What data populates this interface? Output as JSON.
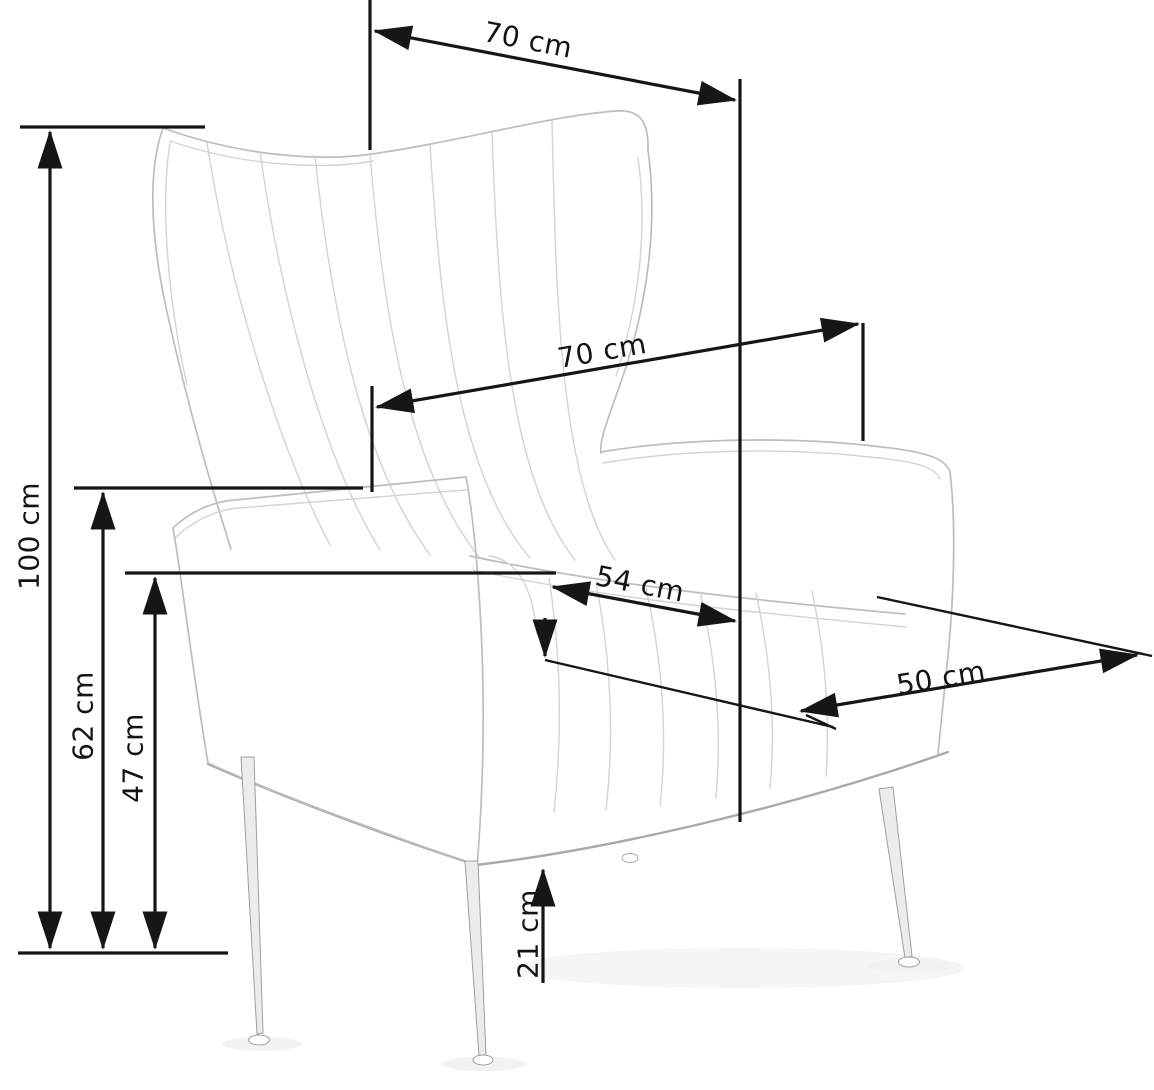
{
  "diagram": {
    "type": "furniture-dimension-drawing",
    "subject": "wingback armchair line sketch with metal legs",
    "unit": "cm",
    "background_color": "#ffffff",
    "dimension_line_color": "#161616",
    "sketch_line_color": "#bdbdbd",
    "dimensions": {
      "top_width": {
        "label": "70 cm",
        "value": 70,
        "orientation": "diagonal-top"
      },
      "back_width": {
        "label": "70 cm",
        "value": 70,
        "orientation": "diagonal-middle"
      },
      "overall_height": {
        "label": "100 cm",
        "value": 100,
        "orientation": "vertical-left"
      },
      "armrest_height": {
        "label": "62 cm",
        "value": 62,
        "orientation": "vertical-left"
      },
      "seat_height": {
        "label": "47 cm",
        "value": 47,
        "orientation": "vertical-left"
      },
      "seat_width": {
        "label": "54 cm",
        "value": 54,
        "orientation": "diagonal-seat"
      },
      "seat_depth": {
        "label": "50 cm",
        "value": 50,
        "orientation": "diagonal-right"
      },
      "leg_clearance": {
        "label": "21 cm",
        "value": 21,
        "orientation": "vertical-bottom"
      }
    }
  }
}
